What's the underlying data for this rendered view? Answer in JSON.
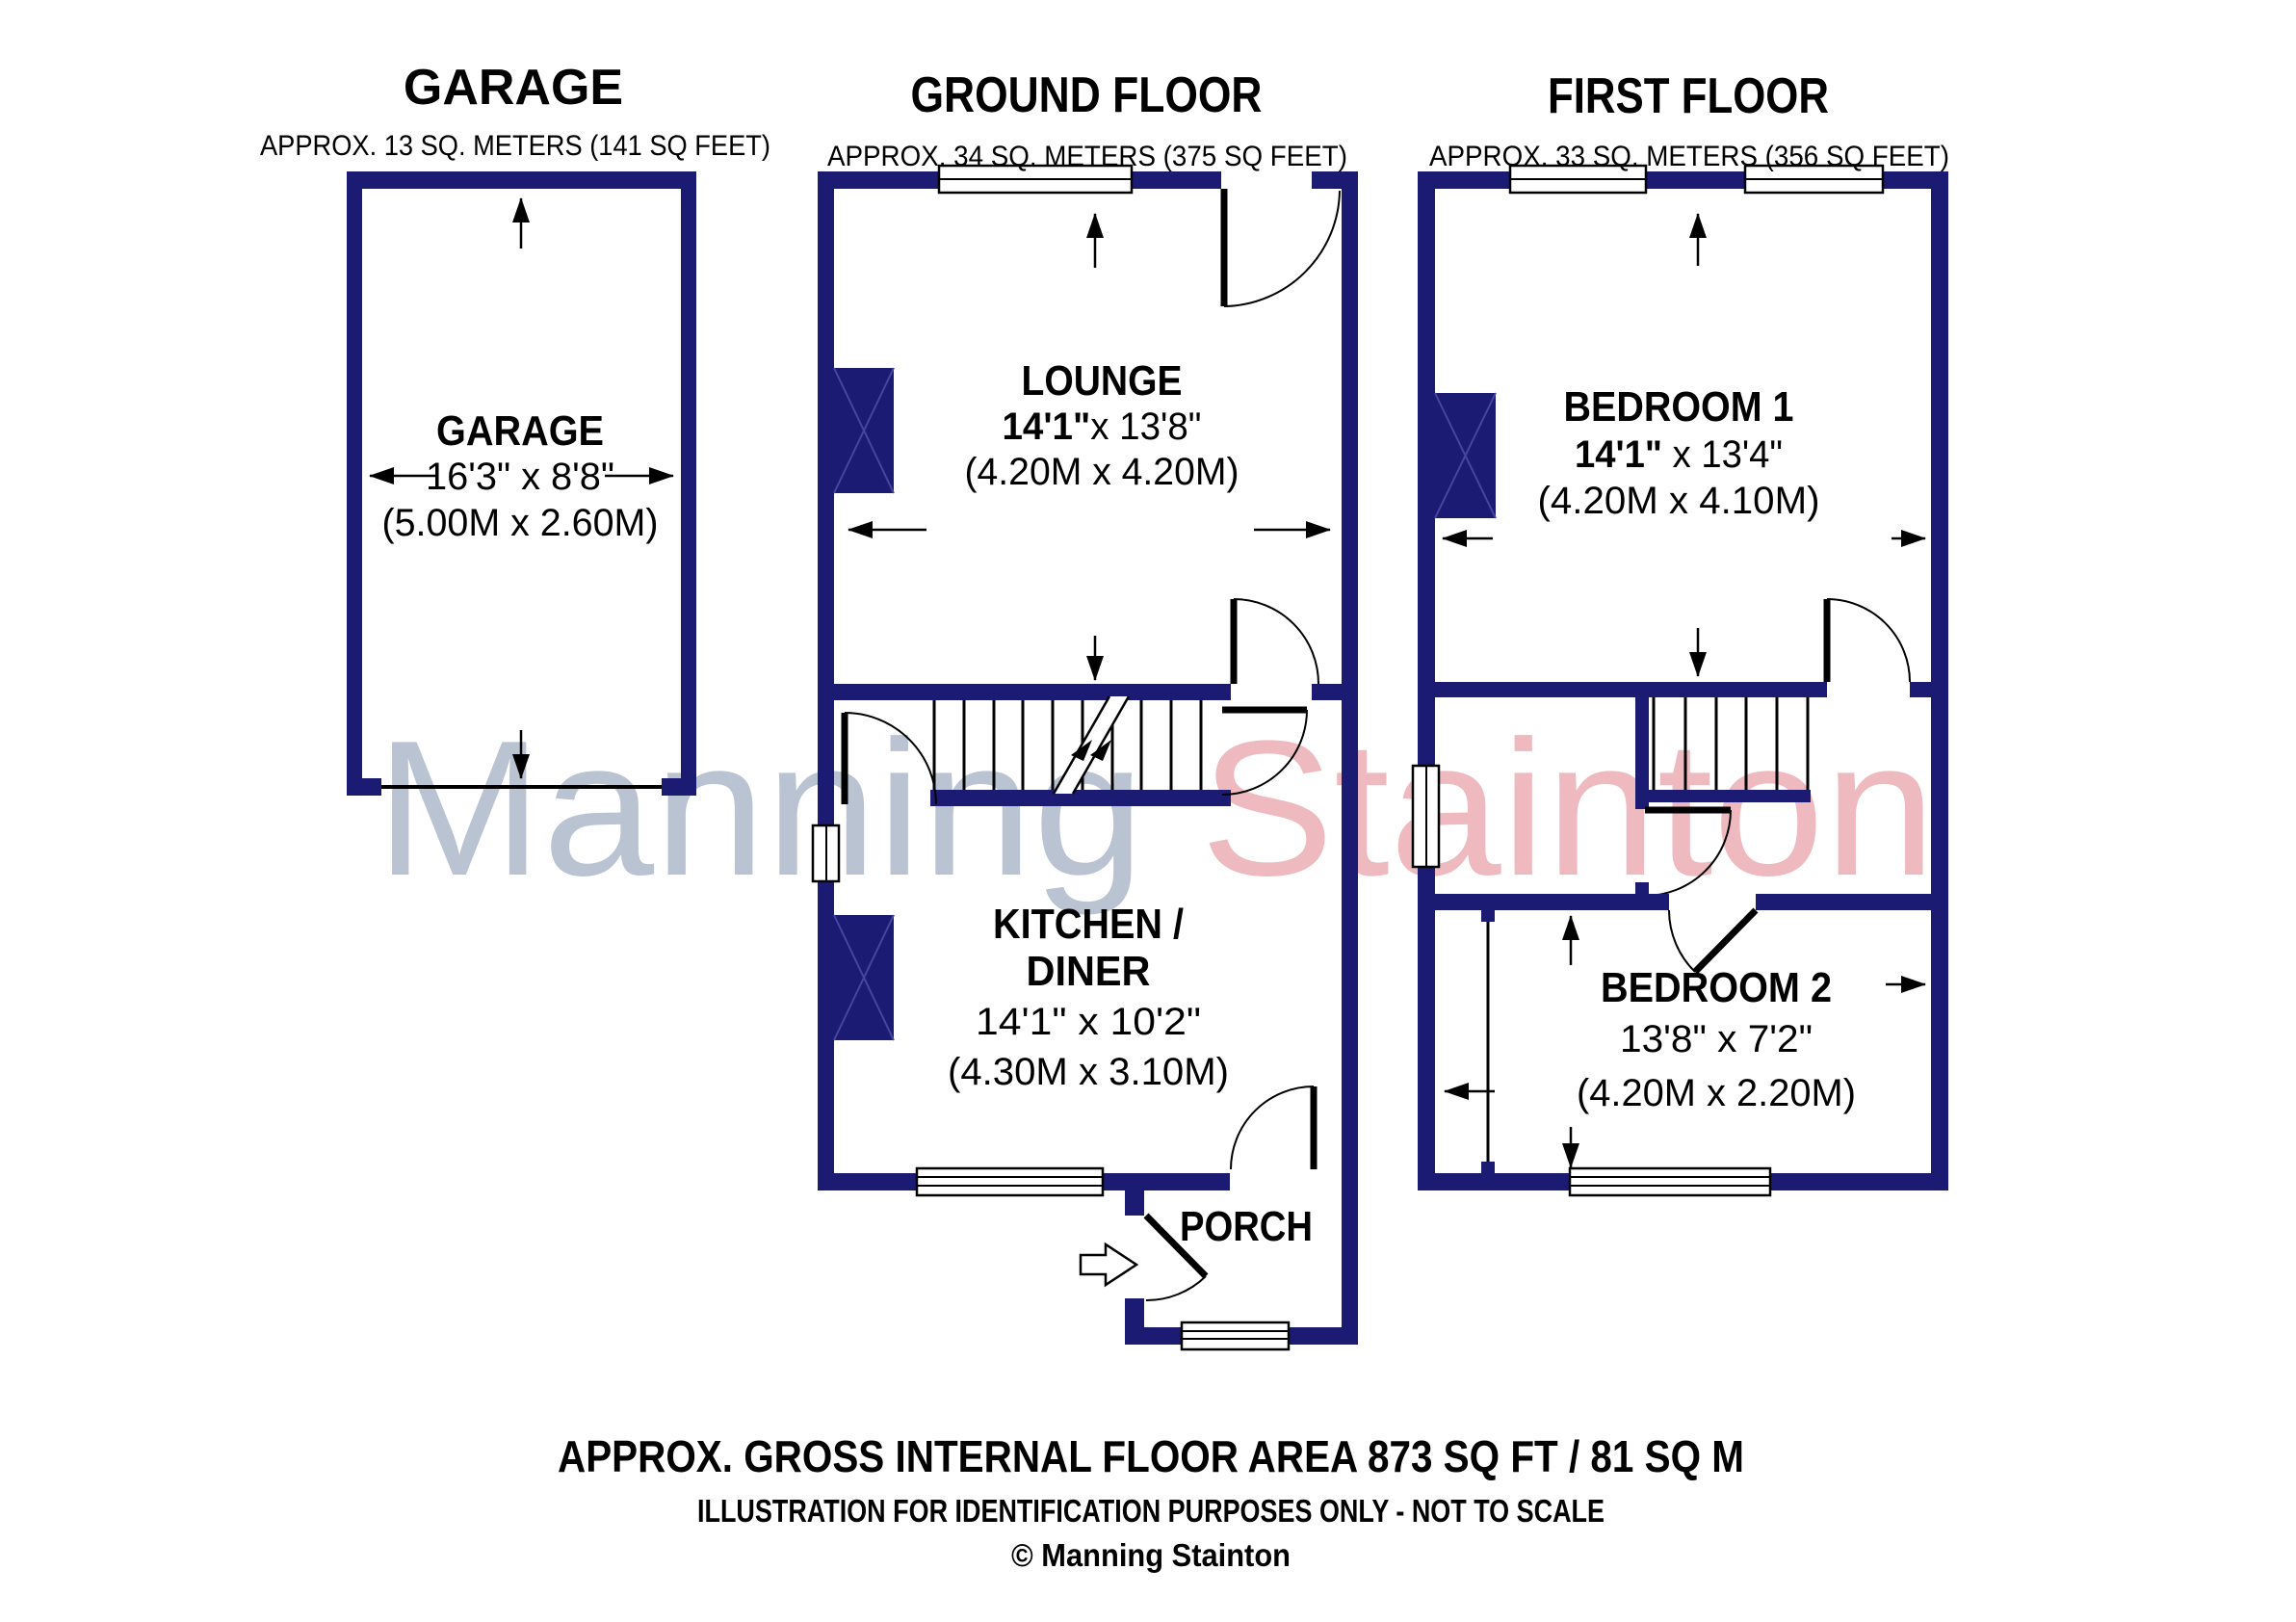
{
  "palette": {
    "wall_navy": "#1b1b74",
    "line_black": "#000000",
    "watermark_gray": "#b9c3d2",
    "watermark_pink": "#eebabf"
  },
  "watermark": {
    "word1": "Manning ",
    "word2": "Stainton"
  },
  "garage": {
    "title": "GARAGE",
    "subtitle": "APPROX. 13 SQ. METERS (141 SQ FEET)",
    "room": {
      "name": "GARAGE",
      "dims_ft": "16'3\" x 8'8\"",
      "dims_m": "(5.00M x 2.60M)"
    }
  },
  "ground": {
    "title": "GROUND FLOOR",
    "subtitle": "APPROX. 34 SQ. METERS (375 SQ FEET)",
    "lounge": {
      "name": "LOUNGE",
      "dims_ft_bold": "14'1\"",
      "dims_ft_rest": "x 13'8\"",
      "dims_m": "(4.20M x 4.20M)"
    },
    "kitchen": {
      "name_line1": "KITCHEN /",
      "name_line2": "DINER",
      "dims_ft": "14'1\" x 10'2\"",
      "dims_m": "(4.30M x 3.10M)"
    },
    "porch": {
      "name": "PORCH"
    }
  },
  "first": {
    "title": "FIRST FLOOR",
    "subtitle": "APPROX. 33 SQ. METERS (356 SQ FEET)",
    "bedroom1": {
      "name": "BEDROOM 1",
      "dims_ft_bold": "14'1\"",
      "dims_ft_rest": " x 13'4\"",
      "dims_m": "(4.20M x 4.10M)"
    },
    "bedroom2": {
      "name": "BEDROOM 2",
      "dims_ft": "13'8\" x 7'2\"",
      "dims_m": "(4.20M x 2.20M)"
    }
  },
  "footer": {
    "line1": "APPROX. GROSS INTERNAL FLOOR AREA 873 SQ FT / 81 SQ M",
    "line2": "ILLUSTRATION FOR IDENTIFICATION PURPOSES ONLY - NOT TO SCALE",
    "line3": "© Manning Stainton"
  }
}
